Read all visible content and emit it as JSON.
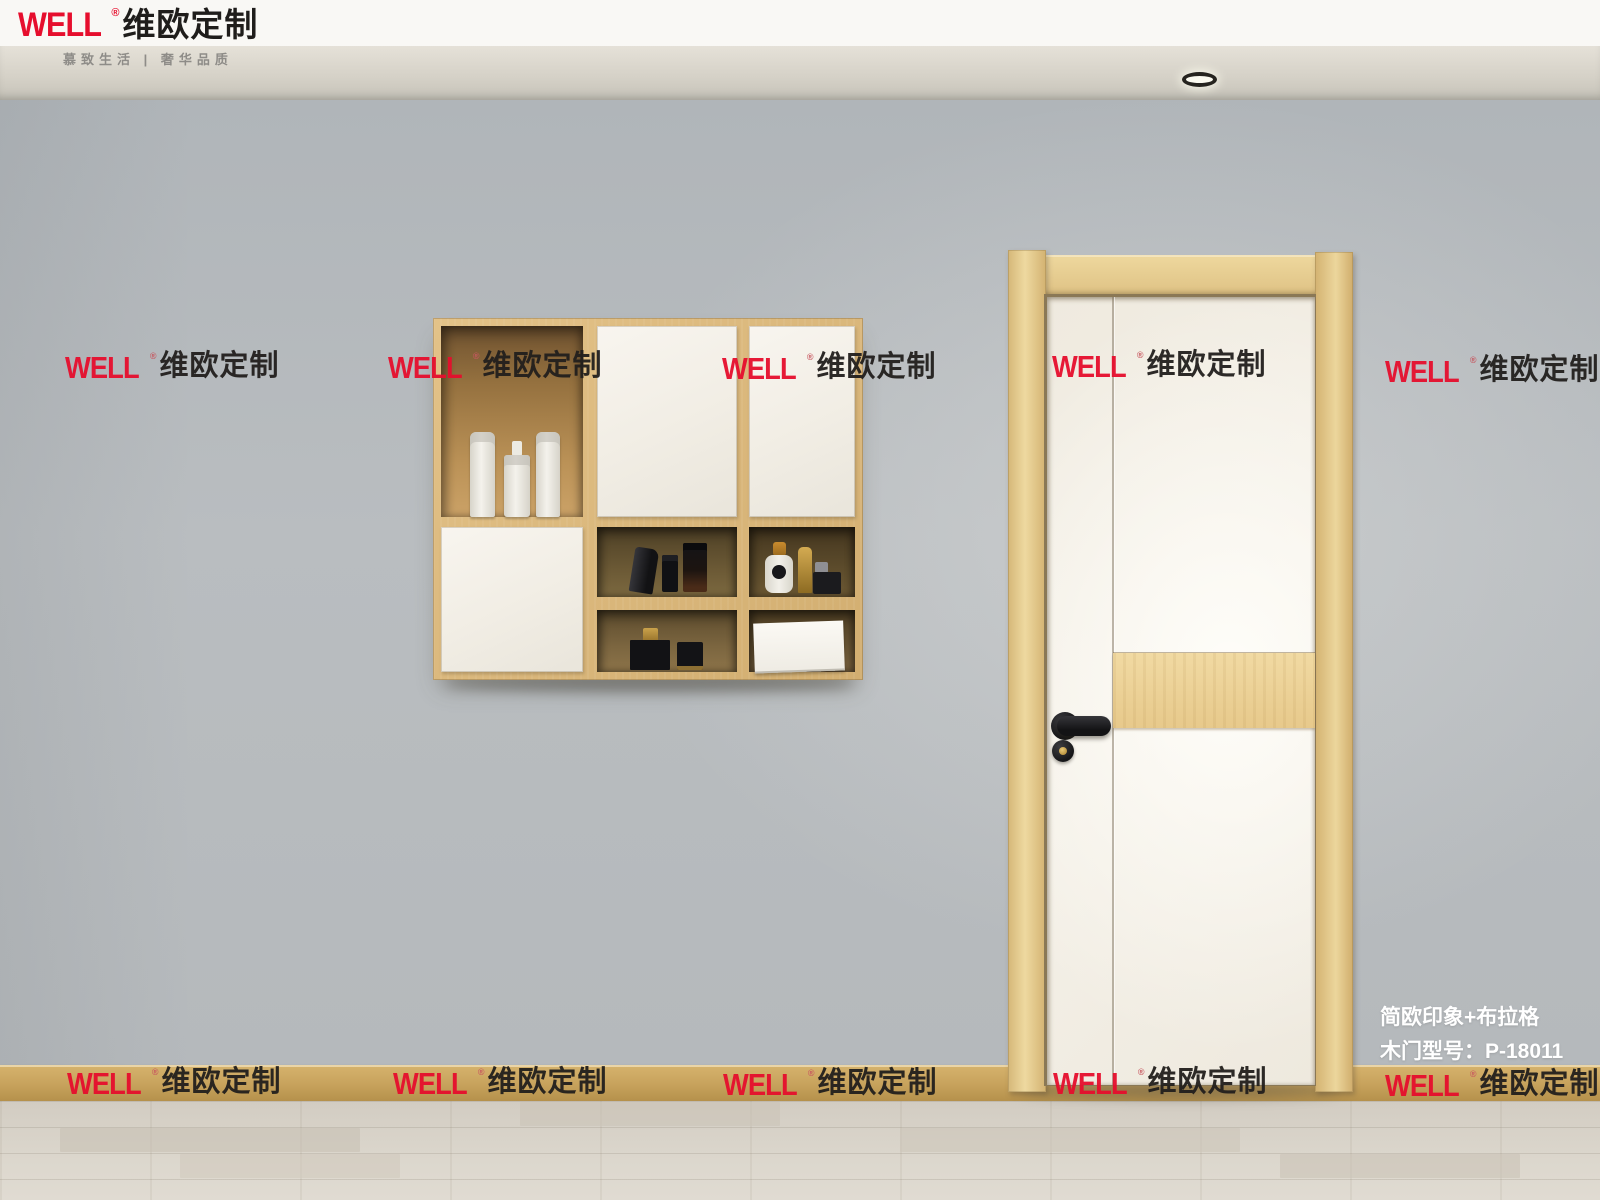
{
  "brand": {
    "well": "WELL",
    "reg": "®",
    "cn": "维欧定制",
    "tagline": "慕致生活 | 奢华品质"
  },
  "watermark": {
    "well": "WELL",
    "reg": "®",
    "cn": "维欧定制"
  },
  "info": {
    "series": "简欧印象+布拉格",
    "model": "木门型号：P-18011"
  },
  "colors": {
    "accent_red": "#e60e2d",
    "logo_black": "#1f1d1b",
    "wall_gray": "#b7bbbd",
    "wood_birch": "#ddba7e",
    "door_white": "#f3efe6",
    "info_text": "#ffffff"
  }
}
